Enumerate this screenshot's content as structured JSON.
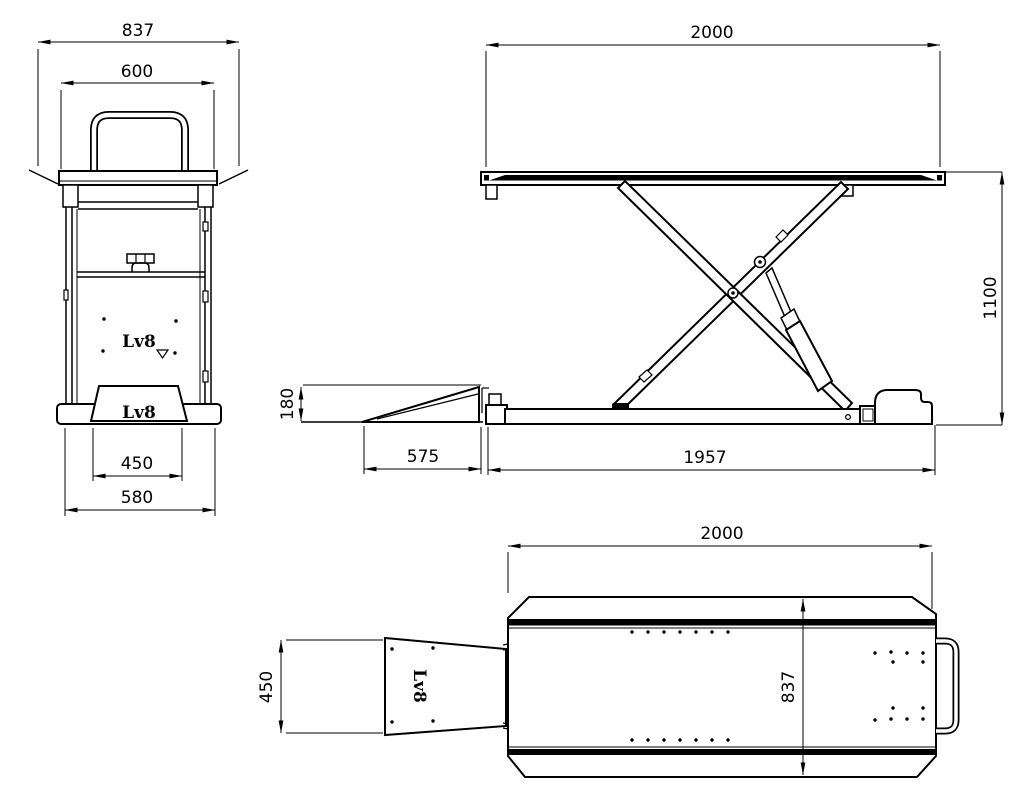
{
  "canvas": {
    "background": "#ffffff",
    "ink": "#000000",
    "description": "Technical drawing, three orthographic views of an Lv8 scissor motorcycle lift"
  },
  "brand": {
    "logo": "Lv8"
  },
  "front_view": {
    "dim_overall_width": "837",
    "dim_handle_width": "600",
    "dim_ramp_width": "450",
    "dim_base_width": "580"
  },
  "side_view": {
    "dim_platform_length": "2000",
    "dim_raised_height": "1100",
    "dim_ramp_height": "180",
    "dim_ramp_length": "575",
    "dim_base_length": "1957"
  },
  "plan_view": {
    "dim_overall_length": "2000",
    "dim_platform_width": "837",
    "dim_ramp_width": "450"
  }
}
